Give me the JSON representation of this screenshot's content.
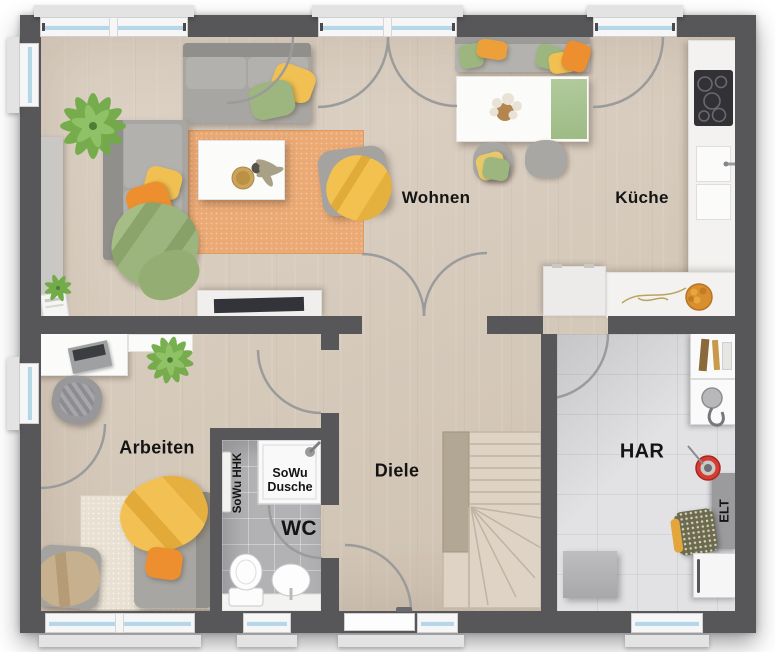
{
  "floorplan": {
    "rooms": {
      "wohnen": {
        "label": "Wohnen"
      },
      "kueche": {
        "label": "Küche"
      },
      "arbeiten": {
        "label": "Arbeiten"
      },
      "diele": {
        "label": "Diele"
      },
      "wc": {
        "label": "WC"
      },
      "har": {
        "label": "HAR"
      }
    },
    "annotations": {
      "dusche": {
        "label": "SoWu Dusche"
      },
      "hhk": {
        "label": "SoWu HHK"
      },
      "elt": {
        "label": "ELT"
      }
    },
    "colors": {
      "wall": "#57575a",
      "wood_floor": "#d8ccbd",
      "bath_tile": "#b2b2b5",
      "har_tile": "#e2e2e4",
      "rug": "#eba974",
      "accent_orange": "#ee8f2f",
      "accent_yellow": "#f0c052",
      "accent_green": "#9db57e",
      "window_glass": "#b5d7e8",
      "stairs": "#ded3c5",
      "door_swing": "#9b9b9b"
    }
  }
}
